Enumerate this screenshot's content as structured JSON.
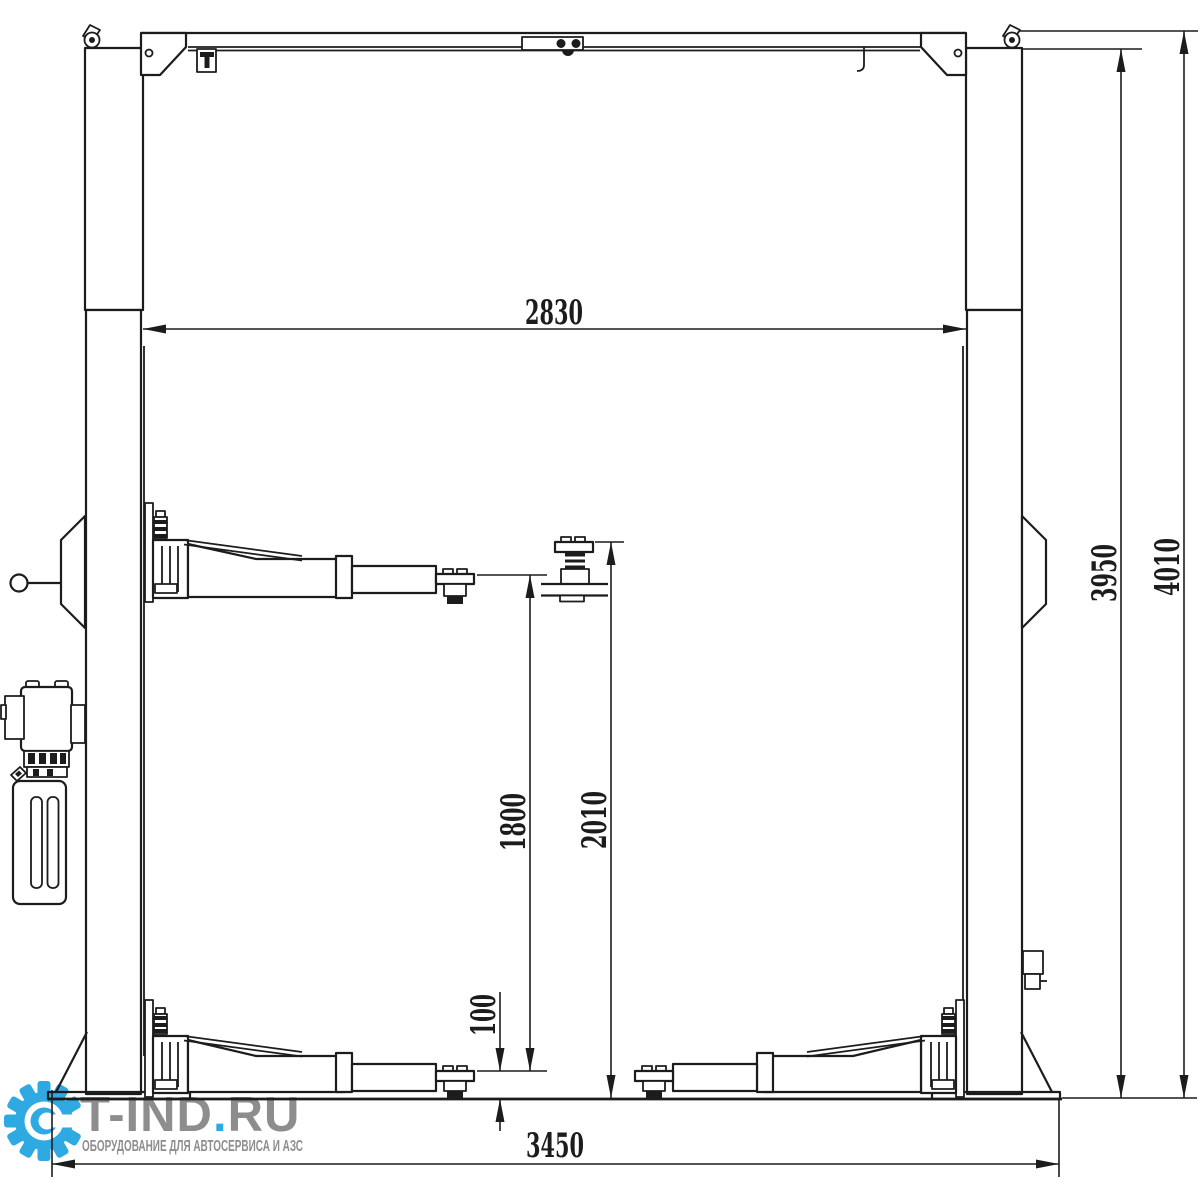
{
  "drawing": {
    "line_color": "#1c1c1c",
    "background": "#ffffff"
  },
  "dimensions": {
    "clear_width_between_posts": "2830",
    "post_height": "3950",
    "overall_height": "4010",
    "lift_height_pad_retracted": "1800",
    "lift_height_pad_extended": "2010",
    "pad_min_height": "100",
    "overall_base_width": "3450"
  },
  "watermark": {
    "brand_main": "T-IND",
    "brand_dot": ".",
    "brand_tld": "RU",
    "tagline": "ОБОРУДОВАНИЕ ДЛЯ АВТОСЕРВИСА И АЗС",
    "colors": {
      "accent": "#2FA9E1",
      "text": "#8D8D8D"
    }
  }
}
